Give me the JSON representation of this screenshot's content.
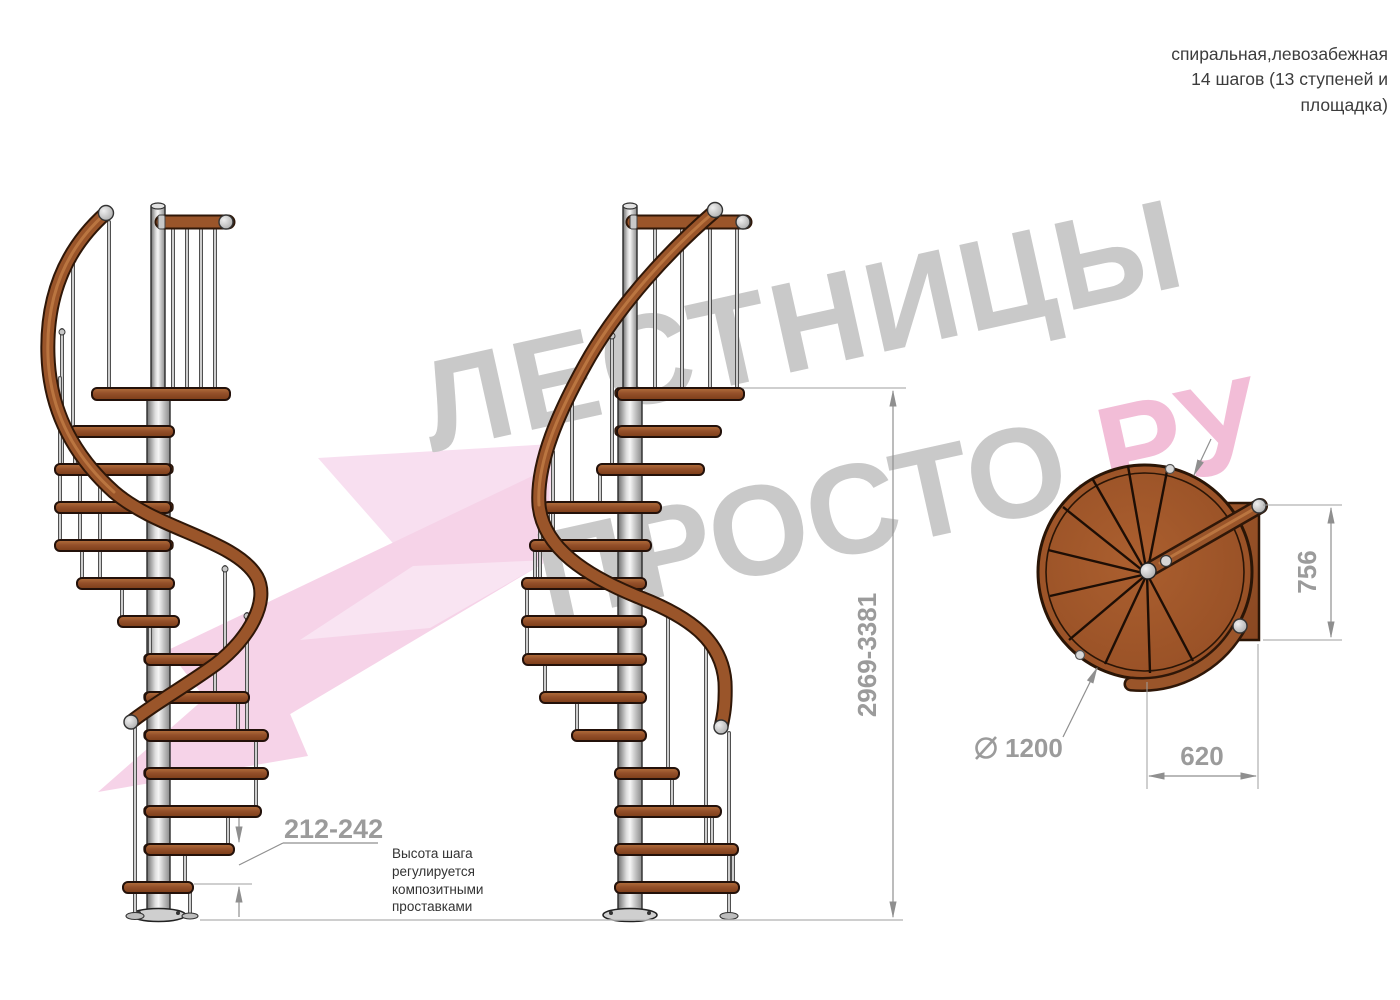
{
  "header_note": {
    "lines": [
      "спиральная,левозабежная",
      "14 шагов (13 ступеней и",
      "площадка)"
    ]
  },
  "step_note": {
    "lines": [
      "Высота шага",
      "регулируется",
      "композитными",
      "проставками"
    ]
  },
  "dimensions": {
    "step_height": "212-242",
    "total_height": "2969-3381",
    "plan_depth": "756",
    "plan_width": "620",
    "plan_diameter": "1200",
    "diameter_symbol": "⌀"
  },
  "watermark": {
    "brand_line1": "ЛЕСТНИЦЫ",
    "brand_line2_gray": "ПРОСТО",
    "brand_line2_pink": ".РУ"
  },
  "colors": {
    "wood": "#95522a",
    "metal": "#d9d9d9",
    "dimension_gray": "#9b9b9b",
    "note_text": "#3c3c3c",
    "watermark_gray": "#c9c9c9",
    "watermark_pink": "#f2bdd7"
  }
}
